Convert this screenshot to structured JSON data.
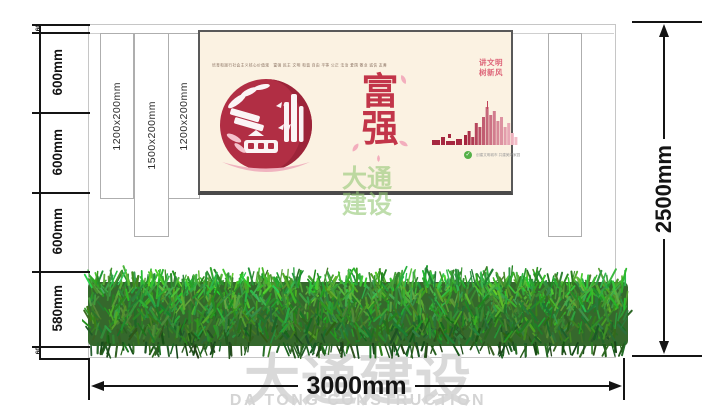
{
  "left_dimension": {
    "labels": [
      "60",
      "600mm",
      "600mm",
      "600mm",
      "580mm",
      "60"
    ]
  },
  "panel_labels": [
    "1200x200mm",
    "1500x200mm",
    "1200x200mm"
  ],
  "bottom_dimension": {
    "label": "3000mm"
  },
  "right_dimension": {
    "label": "2500mm"
  },
  "poster": {
    "top_caption": "培育和践行社会主义核心价值观　富强 民主 文明 和谐 自由 平等 公正 法治 爱国 敬业 诚信 友善",
    "slogan_lines": [
      "讲文明",
      "树新风"
    ],
    "theme_chars": [
      "富",
      "强"
    ],
    "footer_caption": "创建文明城市 共建美好家园"
  },
  "watermarks": {
    "center_lines": [
      "大通",
      "建设"
    ],
    "bottom_cn": "大通建设",
    "bottom_en": "DA TONG CONSTRUCTION"
  },
  "colors": {
    "poster_bg": "#fbf2e2",
    "theme_red": "#c23549",
    "slogan_pink": "#dd6478",
    "papercut_crimson": "#b12e44",
    "watermark_green": "#96c878",
    "watermark_gray": "#d9d9d9",
    "hedge_green": "#3f7a33",
    "dimension_black": "#141414"
  }
}
